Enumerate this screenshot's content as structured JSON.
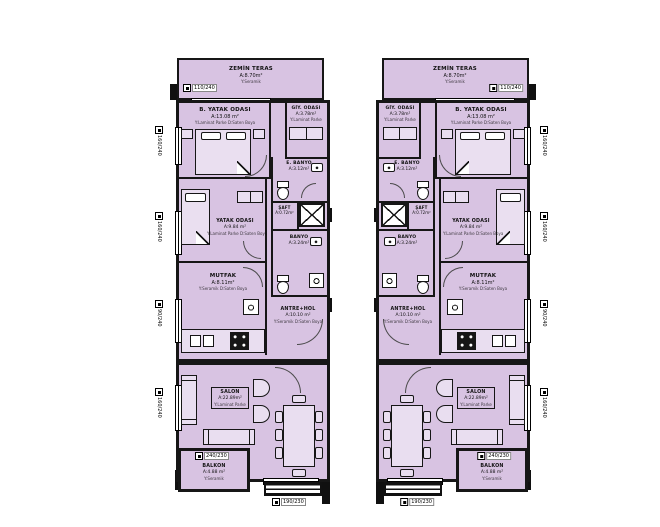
{
  "colors": {
    "room_fill": "#d8c3e2",
    "wall": "#161616"
  },
  "rooms": {
    "terrace": {
      "name": "ZEMİN TERAS",
      "area": "A:8.70m²",
      "sub": "Y:Seramik"
    },
    "master_bedroom": {
      "name": "B. YATAK ODASI",
      "area": "A:13.08 m²",
      "sub": "Y:Laminat Parke D:Saten Boya"
    },
    "dressing": {
      "name": "GİY. ODASI",
      "area": "A:3.78m²",
      "sub": "Y:Laminat Parke"
    },
    "ensuite_bath": {
      "name": "E. BANYO",
      "area": "A:3.12m²",
      "sub": "Y:Seramik D:Fayans"
    },
    "shaft": {
      "name": "ŞAFT",
      "area": "A:0.72m²"
    },
    "bath": {
      "name": "BANYO",
      "area": "A:3.24m²",
      "sub": "Y:Seramik D:Fayans"
    },
    "bedroom": {
      "name": "YATAK ODASI",
      "area": "A:9.84 m²",
      "sub": "Y:Laminat Parke D:Saten Boya"
    },
    "kitchen": {
      "name": "MUTFAK",
      "area": "A:8.11m²",
      "sub": "Y:Seramik D:Saten Boya"
    },
    "hall": {
      "name": "ANTRE+HOL",
      "area": "A:10.10 m²",
      "sub": "Y:Seramik D:Saten Boya"
    },
    "salon": {
      "name": "SALON",
      "area": "A:22.89m²",
      "sub": "Y:Laminat Parke"
    },
    "balcony": {
      "name": "BALKON",
      "area": "A:4.88 m²",
      "sub": "Y:Seramik"
    }
  },
  "tags": {
    "terrace_window": "110/240",
    "side_window_large": "160/240",
    "side_window_small": "90/240",
    "balcony_door": "240/230",
    "entry_door": "190/230"
  }
}
